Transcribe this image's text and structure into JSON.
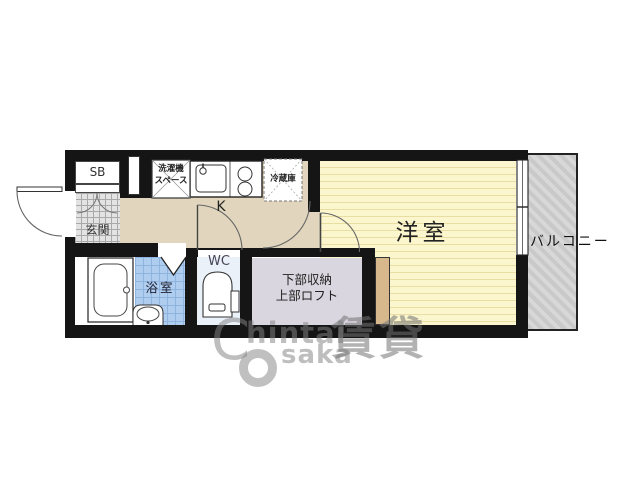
{
  "floorplan": {
    "labels": {
      "shoe_box": "SB",
      "entrance": "玄関",
      "washing_machine_line1": "洗濯機",
      "washing_machine_line2": "スペース",
      "refrigerator": "冷蔵庫",
      "kitchen": "K",
      "western_room": "洋室",
      "balcony": "バルコニー",
      "bathroom": "浴室",
      "toilet": "WC",
      "storage_line1": "下部収納",
      "storage_line2": "上部ロフト"
    },
    "watermark": {
      "c": "C",
      "hintai": "hintai",
      "saka": "saka",
      "cjk": "賃貸"
    },
    "colors": {
      "wall": "#151515",
      "kitchen_floor": "#E1D6BD",
      "room_floor": "#FBF6CD",
      "balcony": "#C9C9C9",
      "bath_tile": "#AECDEF",
      "wc_floor": "#EAF1F8",
      "storage": "#DAD6DF",
      "loft_ladder": "#D6B88C",
      "genkan_tile": "#E3E3E3"
    }
  }
}
